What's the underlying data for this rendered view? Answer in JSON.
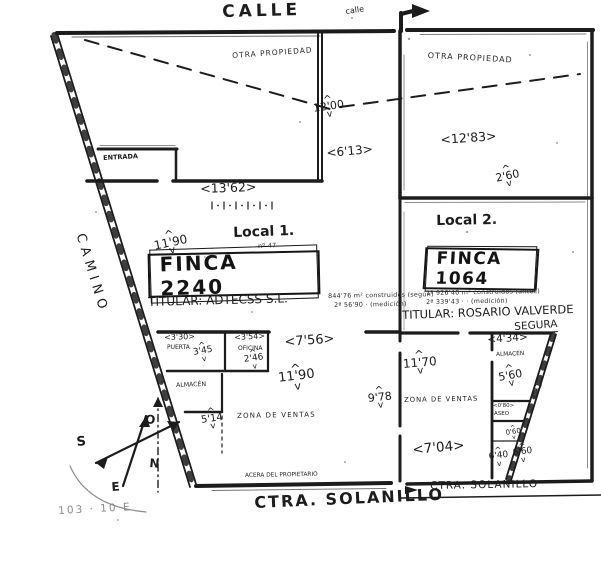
{
  "colors": {
    "ink": "#1c1c1c",
    "paper": "#ffffff",
    "faint": "#8a8a8a"
  },
  "streets": {
    "calle": "CALLE",
    "calle_small": "calle",
    "camino": "CAMINO",
    "ctra_main": "CTRA. SOLANILLO",
    "ctra_right": "CTRA. SOLANILLO",
    "acera": "ACERA DEL PROPIETARIO"
  },
  "boundary": {
    "otra_left": "OTRA PROPIEDAD",
    "otra_right": "OTRA PROPIEDAD"
  },
  "local1": {
    "title": "Local 1.",
    "finca_label": "FINCA 2240",
    "ref_note": "nº 47",
    "titular": "TITULAR: ADTECSS S.L.",
    "note1": "844'76 m² construidos (según)",
    "note2": "2ª 56'90 ·      (medición)",
    "dims": {
      "d1200": "12'00",
      "d613": "<6'13>",
      "d1362": "<13'62>",
      "d1190_top": "11'90",
      "d330": "<3'30>",
      "d345": "3'45",
      "d354": "<3'54>",
      "d246": "2'46",
      "d756": "<7'56>",
      "d1190": "11'90",
      "d514": "5'14",
      "d978": "9'78"
    },
    "rooms": {
      "entrada": "ENTRADA",
      "puerta": "PUERTA",
      "oficina": "OFICINA",
      "almacen": "ALMACÉN",
      "zona": "ZONA DE VENTAS"
    }
  },
  "local2": {
    "title": "Local 2.",
    "finca_label": "FINCA 1064",
    "titular1": "TITULAR: ROSARIO VALVERDE",
    "titular2": "SEGURA",
    "note1": "1ª 926'40 m² construidos (antes)",
    "note2": "2ª 339'43 ·   ·   (medición)",
    "dims": {
      "d1283": "<12'83>",
      "d260": "2'60",
      "d1170": "11'70",
      "d704": "<7'04>",
      "d434": "<4'34>",
      "d560": "5'60",
      "d080": "<0'80>",
      "d131": "1'31",
      "d060": "0'60",
      "d640": "6'40",
      "d660": "6'60"
    },
    "rooms": {
      "almacen": "ALMACÉN",
      "aseo": "ASEO",
      "zona": "ZONA DE VENTAS"
    }
  },
  "compass": {
    "n": "N",
    "s": "S",
    "e": "E",
    "o": "O"
  },
  "footer_scribble": "103 · 10 E"
}
